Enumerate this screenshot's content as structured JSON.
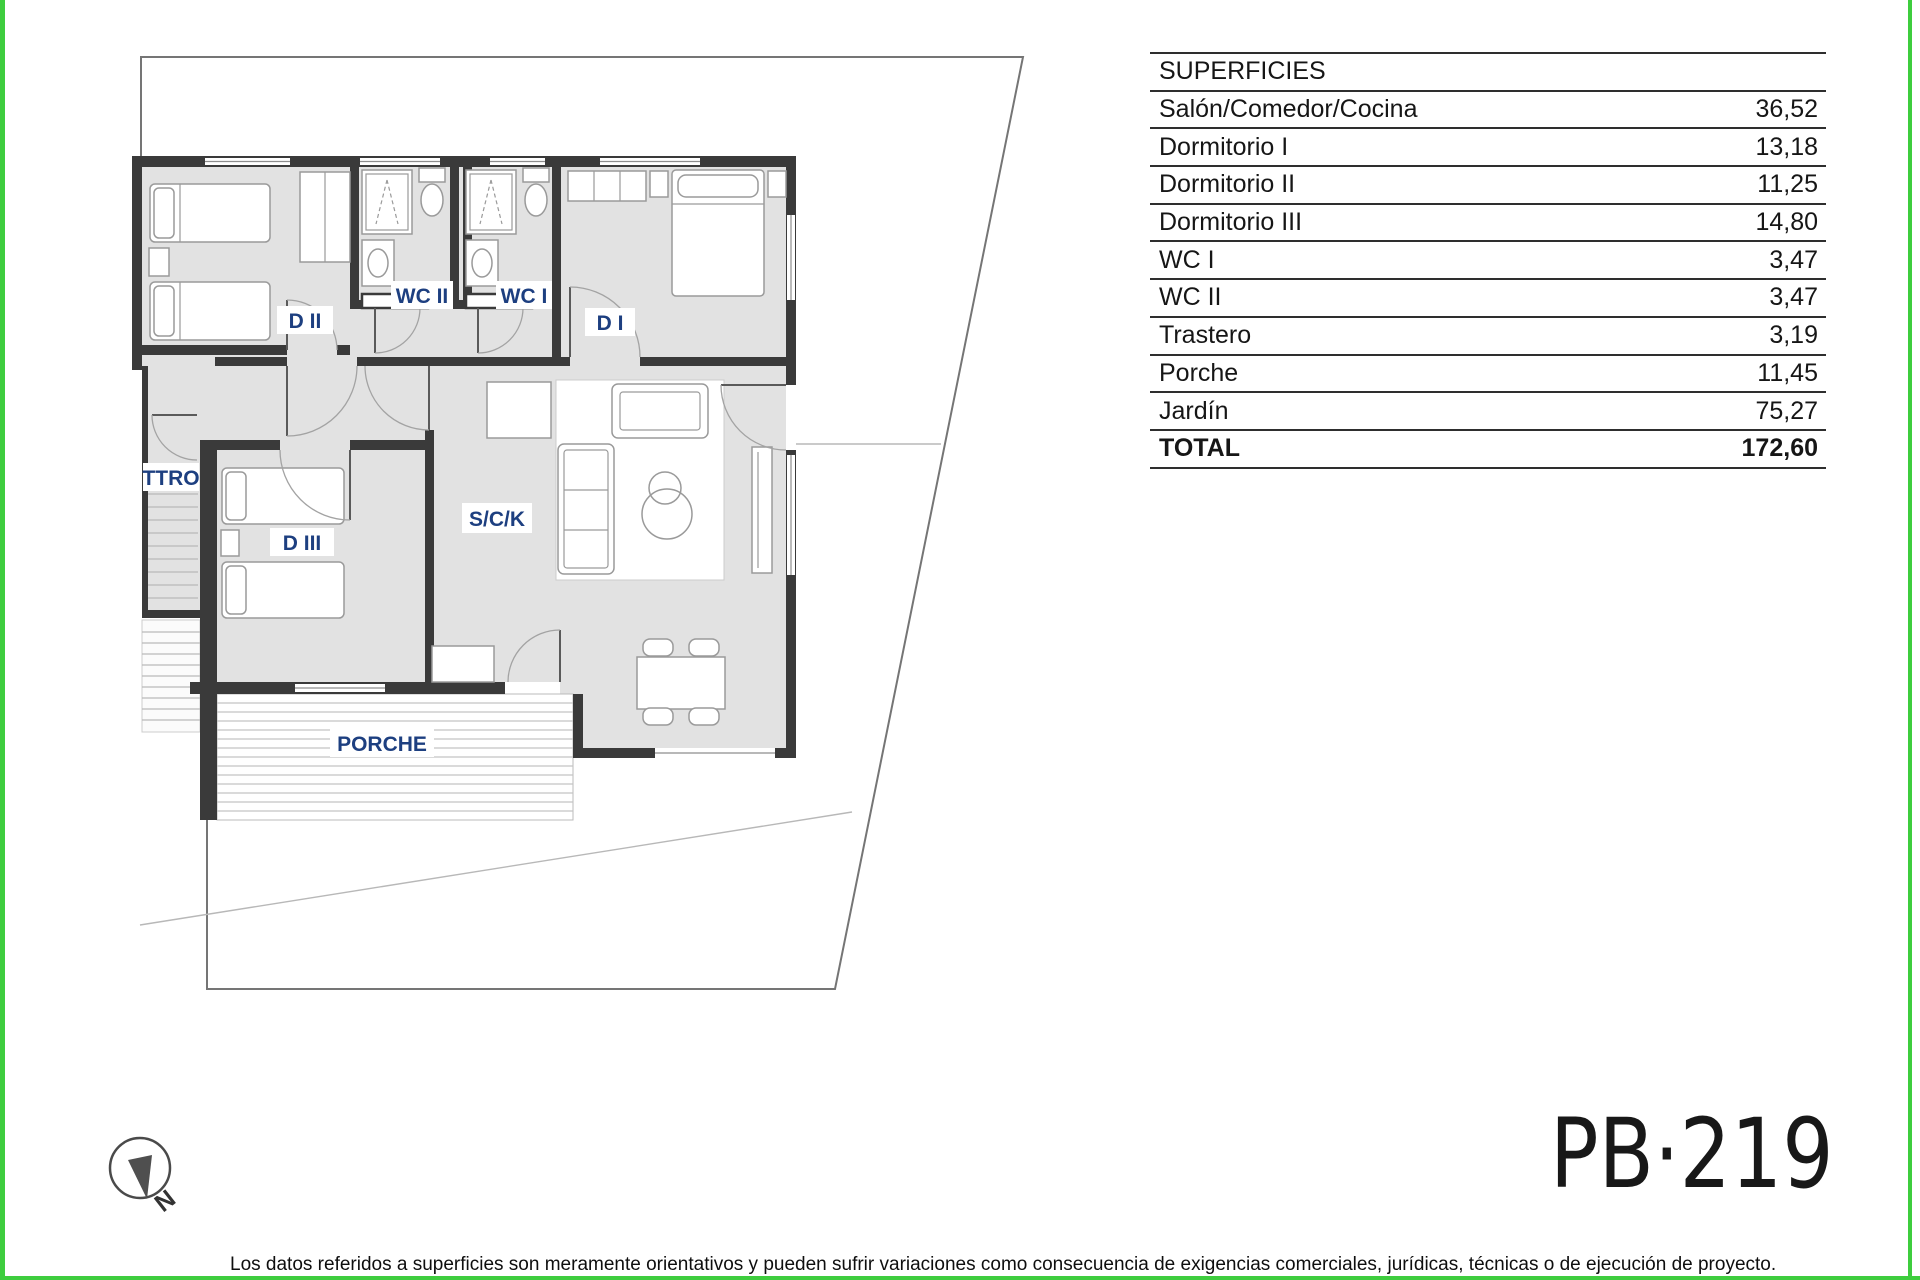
{
  "colors": {
    "accent_green": "#3ecd3e",
    "room_label_blue": "#1d3f80",
    "wall_gray": "#3a3a3a",
    "floor_gray": "#e2e2e2"
  },
  "plan": {
    "labels": {
      "d2": "D II",
      "wc2": "WC II",
      "wc1": "WC I",
      "d1": "D I",
      "ttro": "TTRO",
      "d3": "D III",
      "sck": "S/C/K",
      "porche": "PORCHE"
    },
    "north": "N"
  },
  "surface_table": {
    "header": "SUPERFICIES",
    "rows": [
      {
        "label": "Salón/Comedor/Cocina",
        "value": "36,52"
      },
      {
        "label": "Dormitorio I",
        "value": "13,18"
      },
      {
        "label": "Dormitorio II",
        "value": "11,25"
      },
      {
        "label": "Dormitorio III",
        "value": "14,80"
      },
      {
        "label": "WC I",
        "value": "3,47"
      },
      {
        "label": "WC II",
        "value": "3,47"
      },
      {
        "label": "Trastero",
        "value": "3,19"
      },
      {
        "label": "Porche",
        "value": "11,45"
      },
      {
        "label": "Jardín",
        "value": "75,27"
      }
    ],
    "total": {
      "label": "TOTAL",
      "value": "172,60"
    }
  },
  "plan_code": "PB·219",
  "disclaimer": "Los datos referidos a superficies son meramente orientativos y pueden sufrir variaciones como consecuencia de exigencias comerciales, jurídicas, técnicas o de ejecución de proyecto."
}
